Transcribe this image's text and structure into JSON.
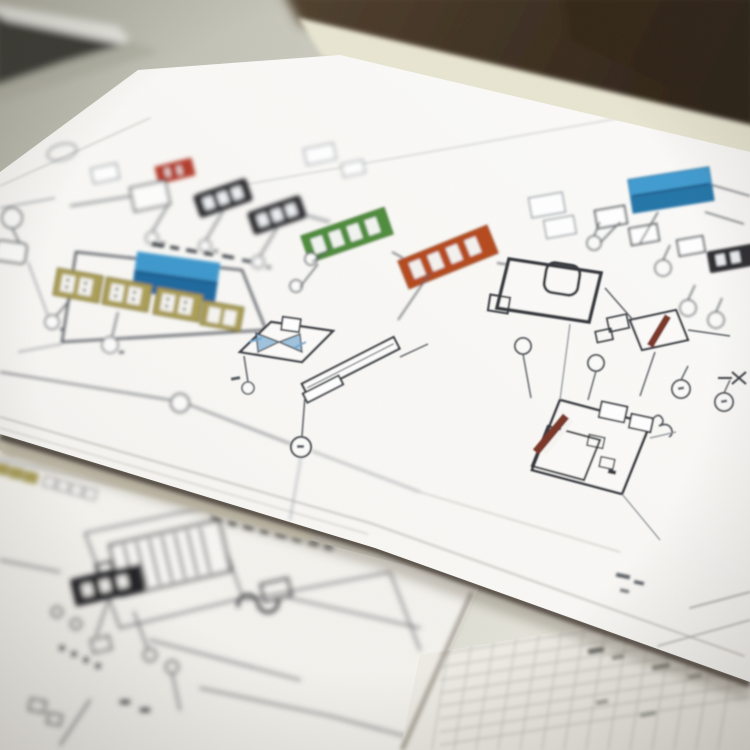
{
  "scene": {
    "type": "photograph",
    "subject": "printed engineering process-flow diagrams on paper sheets lying on a desk, shallow depth of field",
    "background": {
      "wall_color": "#3a2d1f",
      "wall_color_light": "#55432f",
      "desk_color": "#c9c9bd",
      "desk_color_light": "#e9e8de",
      "desk_edge_color": "#e8e5d1",
      "laptop_body_color": "#3a3a36",
      "laptop_edge_color": "#e6e6e0"
    },
    "sheets": [
      {
        "id": "main-sheet",
        "paper_color": "#f9f8f5",
        "content": "colored process flow diagram with unit blocks, instrument circles and connector lines"
      },
      {
        "id": "lower-sheet",
        "paper_color": "#f3f2ed",
        "content": "monochrome piping diagram with title strip and heat-exchanger symbols"
      },
      {
        "id": "grid-sheet",
        "paper_color": "#edebe4",
        "content": "faint spreadsheet-style data grid"
      }
    ],
    "diagram": {
      "ink": "#3c4046",
      "ink_light": "#9aa0a6",
      "blocks": {
        "red_marker": "#b23a2c",
        "blue_unit": "#3e97cc",
        "blue_unit_dark": "#1d689e",
        "blue_unit_2": "#3f9bd0",
        "blue_unit_2_dark": "#2374a8",
        "green_unit": "#4e8c3a",
        "orange_unit": "#b54a1f",
        "khaki_unit": "#ab9e55",
        "dark_unit": "#2d2d31",
        "maroon_bar": "#7a3526",
        "valve_fill": "#8fb9d9"
      }
    },
    "shadows": {
      "sheet_edge": "#3a332c",
      "soft": "#756a5c"
    }
  }
}
